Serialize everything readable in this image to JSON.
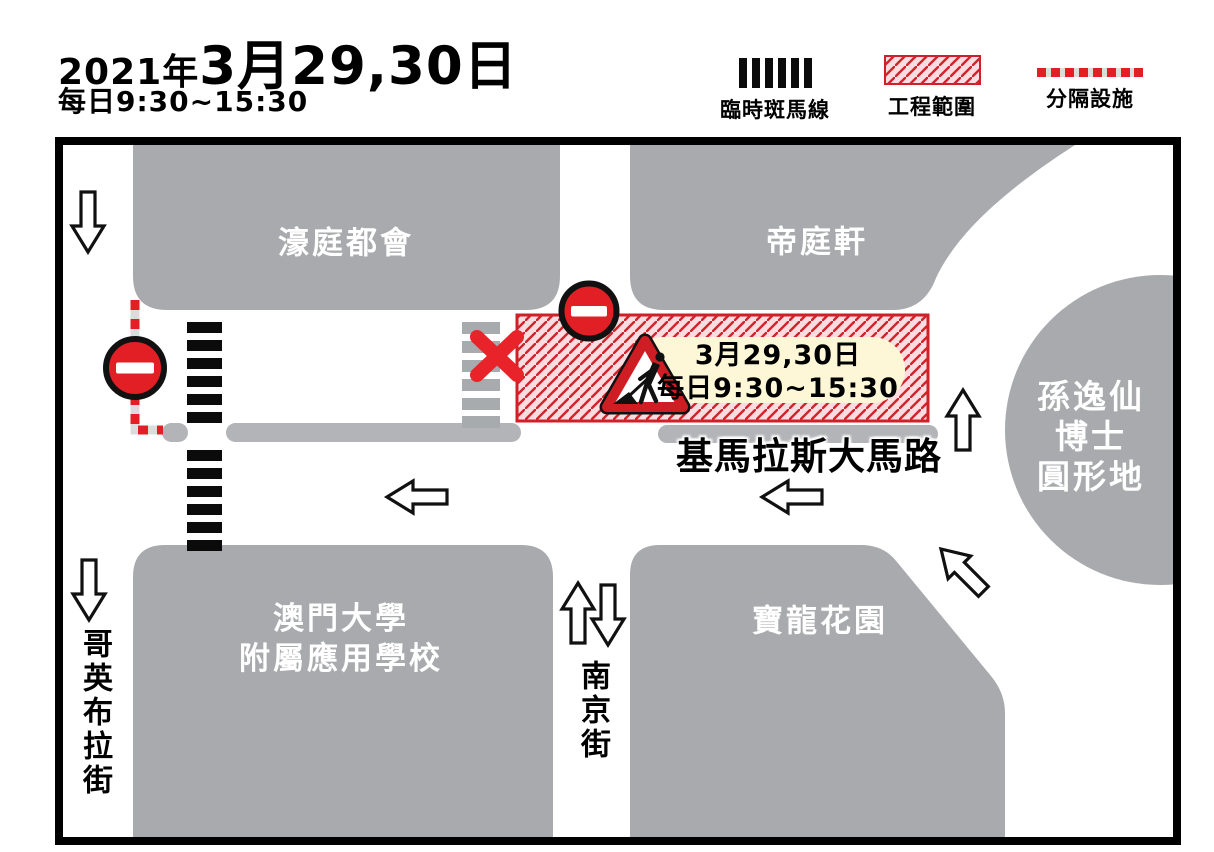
{
  "header": {
    "year": "2021年",
    "date": "3月29,30日",
    "time": "每日9:30~15:30"
  },
  "legend": {
    "zebra_label": "臨時斑馬線",
    "works_label": "工程範圍",
    "divider_label": "分隔設施"
  },
  "map": {
    "buildings": {
      "hou_ting_tou_wui": "濠庭都會",
      "tai_ting_hin": "帝庭軒",
      "roundabout_line1": "孫逸仙",
      "roundabout_line2": "博士",
      "roundabout_line3": "圓形地",
      "school_line1": "澳門大學",
      "school_line2": "附屬應用學校",
      "pou_long_garden": "寶龍花園"
    },
    "streets": {
      "coimbra": "哥英布拉街",
      "nanjing": "南京街",
      "guimaraes": "基馬拉斯大馬路"
    },
    "works_sign": {
      "line1": "3月29,30日",
      "line2": "每日9:30~15:30"
    }
  },
  "colors": {
    "building_gray": "#a8aaad",
    "median_gray": "#b2b4b7",
    "sign_red": "#e31f26",
    "hatch_line_red": "#d2232a",
    "hatch_bg_pink": "#fbdce1",
    "works_label_bg": "#fdf7d8",
    "frame_black": "#000000"
  }
}
